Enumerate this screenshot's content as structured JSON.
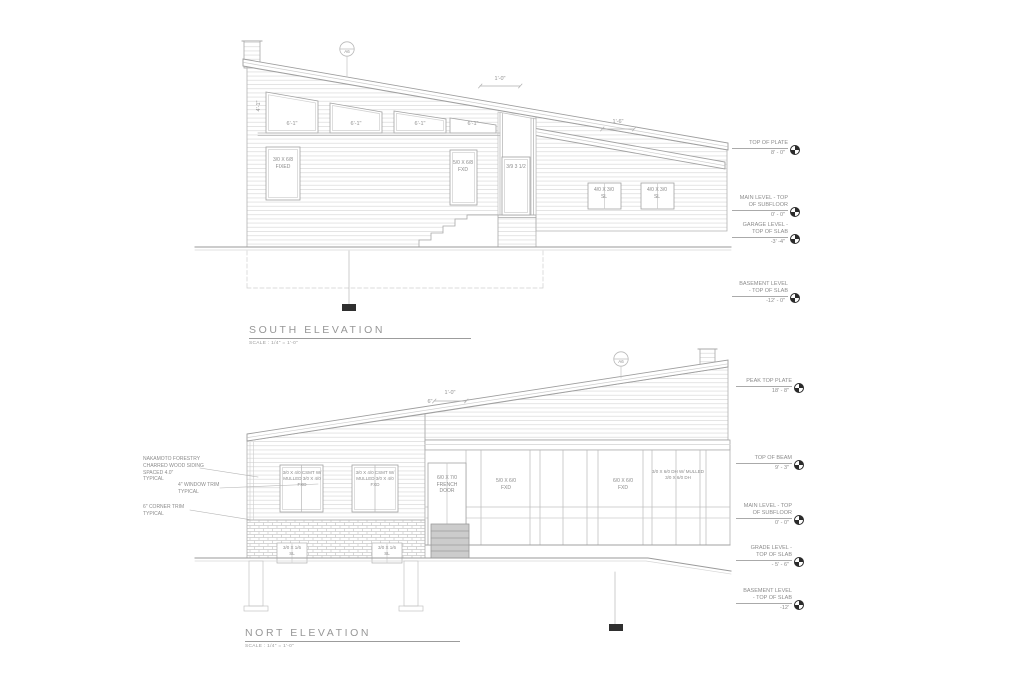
{
  "south": {
    "title": "SOUTH ELEVATION",
    "scale": "SCALE :  1/4\" = 1'-0\"",
    "section_marker": "A6",
    "dims": {
      "roof_overhang": "1'-0\"",
      "garage_roof_overhang": "1'-6\"",
      "clerestory_width": "6'-1\"",
      "clerestory_height": "4'-1\""
    },
    "windows": {
      "fixed_left": "3/0 X 6/8\nFIXED",
      "fixed_right": "5/0 X 6/8\nFXD",
      "entry_door": "3/9 3 1/2",
      "garage_left": "4/0 X 3/0\nSL",
      "garage_right": "4/0 X 3/0\nSL"
    },
    "levels": [
      {
        "name": "TOP OF PLATE",
        "elevation": "8' - 0\""
      },
      {
        "name": "MAIN LEVEL - TOP\nOF SUBFLOOR",
        "elevation": "0' - 0\""
      },
      {
        "name": "GARAGE LEVEL -\nTOP OF SLAB",
        "elevation": "-3' -4\""
      },
      {
        "name": "BASEMENT LEVEL\n- TOP OF SLAB",
        "elevation": "-12' - 0\""
      }
    ]
  },
  "north": {
    "title": "NORT ELEVATION",
    "scale": "SCALE :  1/4\" = 1'-0\"",
    "section_marker": "A6",
    "dims": {
      "roof_overhang": "1'-0\"",
      "fascia_offset": "6\""
    },
    "notes": [
      {
        "text": "NAKAMOTO FORESTRY\nCHARRED WOOD SIDING\nSPACED 4.0\"\nTYPICAL"
      },
      {
        "text": "4\" WINDOW TRIM\nTYPICAL"
      },
      {
        "text": "6\" CORNER TRIM\nTYPICAL"
      }
    ],
    "windows": {
      "casement_left": "3/0 X 4/0 CSMT W/\nMULLED 3/0 X 4/0 FXD",
      "casement_right": "3/0 X 4/0 CSMT W/\nMULLED 3/0 X 4/0 FXD",
      "french_door": "6/0 X 7/0\nFRENCH DOOR",
      "fixed_left": "5/0 X 6/0\nFXD",
      "fixed_right": "6/0 X 6/0\nFXD",
      "double_hung": "3/0 X 6/0 DH W/ MULLED\n3/0 X 6/0 DH",
      "basement_left": "3/0 X 1/6\nSL",
      "basement_right": "3/0 X 1/6\nSL"
    },
    "levels": [
      {
        "name": "PEAK TOP PLATE",
        "elevation": "18' - 8\""
      },
      {
        "name": "TOP OF BEAM",
        "elevation": "9' - 3\""
      },
      {
        "name": "MAIN LEVEL - TOP\nOF SUBFLOOR",
        "elevation": "0' - 0\""
      },
      {
        "name": "GRADE LEVEL -\nTOP OF SLAB",
        "elevation": "- 5' - 6\""
      },
      {
        "name": "BASEMENT LEVEL\n- TOP OF SLAB",
        "elevation": "-12'"
      }
    ]
  }
}
